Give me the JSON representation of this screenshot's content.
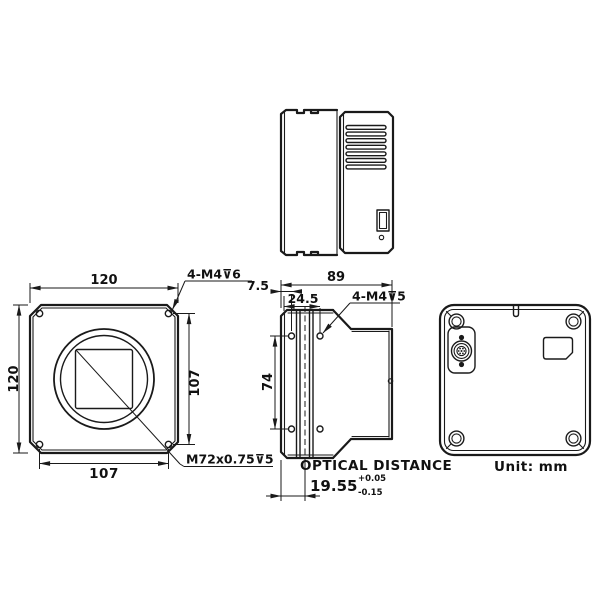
{
  "drawing": {
    "front_view": {
      "dim_width_top": "120",
      "dim_height_left": "120",
      "dim_hole_spacing_right": "107",
      "dim_hole_spacing_bottom": "107",
      "corner_thread_note": "4-M4⊽6",
      "lens_mount_note": "M72x0.75⊽5"
    },
    "side_view": {
      "dim_total_depth": "89",
      "dim_front_to_first_hole": "7.5",
      "dim_front_to_second_hole": "24.5",
      "dim_hole_spacing": "74",
      "thread_note": "4-M4⊽5",
      "optical_distance_label": "OPTICAL  DISTANCE",
      "optical_distance_value": "19.55",
      "tolerance_plus": "+0.05",
      "tolerance_minus": "-0.15"
    },
    "footer": {
      "unit_note": "Unit: mm"
    }
  }
}
